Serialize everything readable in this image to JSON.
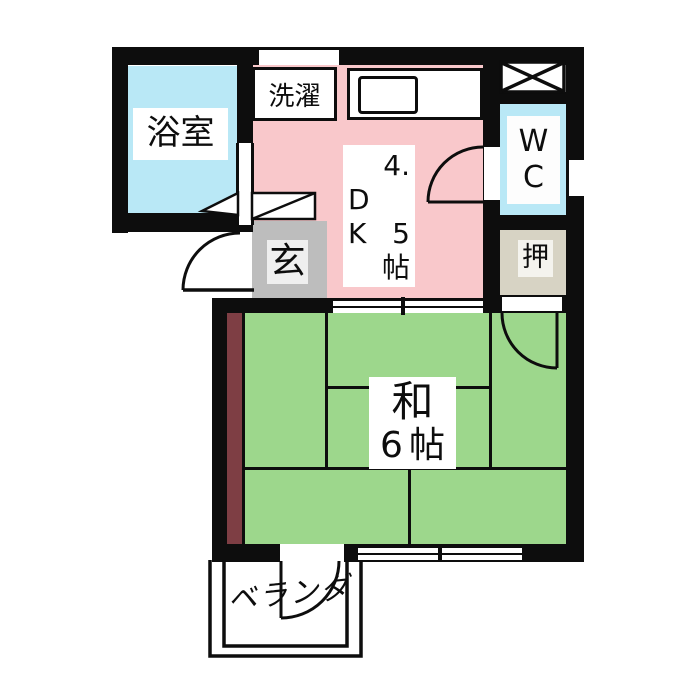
{
  "colors": {
    "wall": "#0d0d0d",
    "bath": "#b9e8f6",
    "dk": "#f9c8cb",
    "washitsu": "#9dd78c",
    "genkan": "#bdbdbd",
    "genkan_label": "#efefef",
    "oshiire": "#d7d3c4",
    "oshiire_label": "#f4f3ee",
    "maroon": "#7e3e44",
    "paper": "#ffffff"
  },
  "rooms": {
    "bath": {
      "label": "浴室"
    },
    "dk": {
      "lines": [
        "4.",
        "D",
        "K 5",
        "帖"
      ]
    },
    "wc": {
      "lines": [
        "W",
        "C"
      ]
    },
    "genkan": {
      "label": "玄"
    },
    "oshiire": {
      "label": "押"
    },
    "washitsu": {
      "lines": [
        "和",
        "6帖"
      ]
    }
  },
  "fixtures": {
    "laundry": {
      "label": "洗濯"
    }
  },
  "exterior": {
    "veranda": {
      "label": "ベランダ"
    }
  }
}
